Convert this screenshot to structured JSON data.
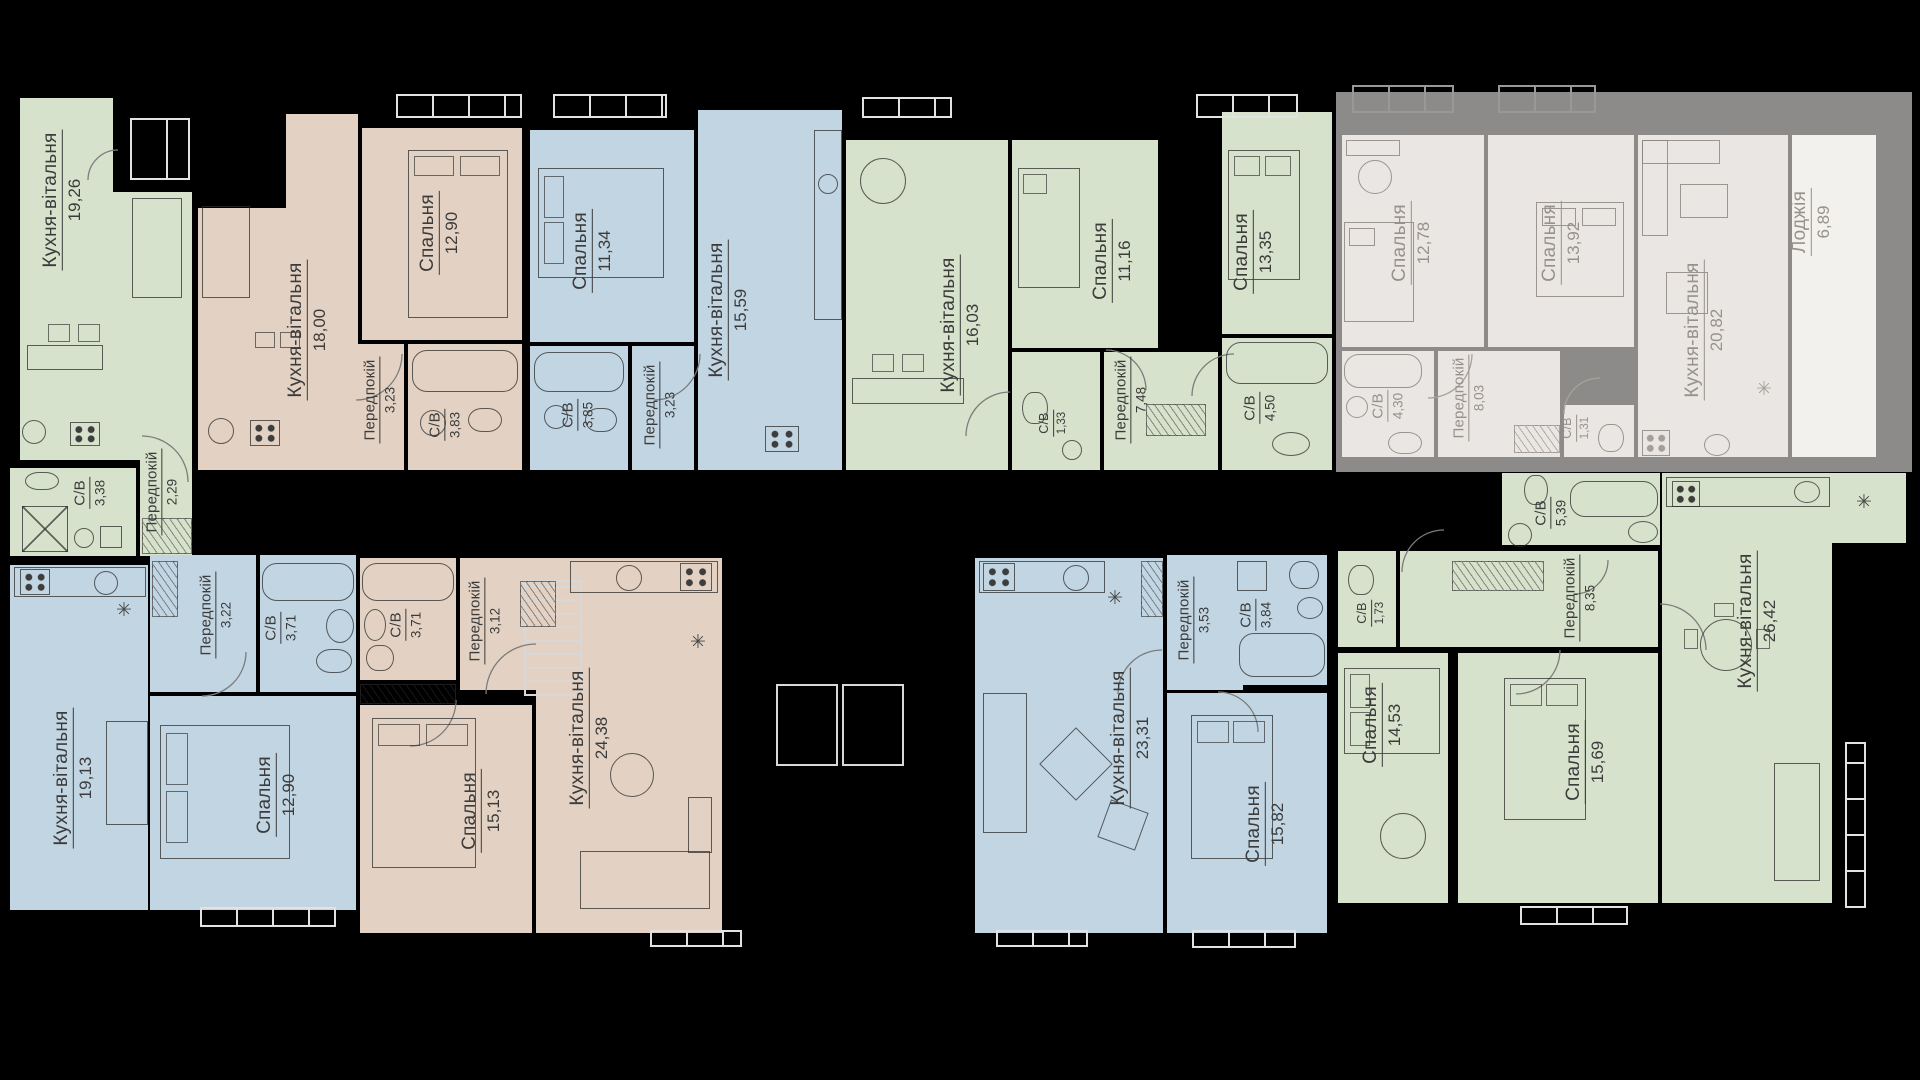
{
  "page": {
    "background": "#000000",
    "colors": {
      "green": "#d6e2cb",
      "tan": "#e3d2c3",
      "blue": "#c2d5e2",
      "faded_fill": "#e9e6e3",
      "faded_wall": "#8d8b89"
    }
  },
  "icons": {
    "fixture": "✳"
  },
  "apartments": [
    {
      "id": "top-1",
      "palette": "green",
      "status": "available",
      "rooms": [
        {
          "name": "Кухня-вітальня",
          "area": "19,26"
        },
        {
          "name": "С/В",
          "area": "3,38"
        },
        {
          "name": "Передпокій",
          "area": "2,29"
        }
      ]
    },
    {
      "id": "top-2",
      "palette": "tan",
      "status": "available",
      "rooms": [
        {
          "name": "Кухня-вітальня",
          "area": "18,00"
        },
        {
          "name": "Спальня",
          "area": "12,90"
        },
        {
          "name": "Передпокій",
          "area": "3,23"
        },
        {
          "name": "С/В",
          "area": "3,83"
        }
      ]
    },
    {
      "id": "top-3",
      "palette": "blue",
      "status": "available",
      "rooms": [
        {
          "name": "Спальня",
          "area": "11,34"
        },
        {
          "name": "С/В",
          "area": "3,85"
        },
        {
          "name": "Передпокій",
          "area": "3,23"
        },
        {
          "name": "Кухня-вітальня",
          "area": "15,59"
        }
      ]
    },
    {
      "id": "top-4",
      "palette": "green",
      "status": "available",
      "rooms": [
        {
          "name": "Кухня-вітальня",
          "area": "16,03"
        },
        {
          "name": "Спальня",
          "area": "11,16"
        },
        {
          "name": "С/В",
          "area": "1,33"
        },
        {
          "name": "Передпокій",
          "area": "7,48"
        },
        {
          "name": "Спальня",
          "area": "13,35"
        },
        {
          "name": "С/В",
          "area": "4,50"
        }
      ]
    },
    {
      "id": "top-5",
      "palette": "faded",
      "status": "unavailable",
      "rooms": [
        {
          "name": "Спальня",
          "area": "12,78"
        },
        {
          "name": "Спальня",
          "area": "13,92"
        },
        {
          "name": "Кухня-вітальня",
          "area": "20,82"
        },
        {
          "name": "Лоджія",
          "area": "6,89"
        },
        {
          "name": "С/В",
          "area": "4,30"
        },
        {
          "name": "Передпокій",
          "area": "8,03"
        },
        {
          "name": "С/В",
          "area": "1,31"
        }
      ]
    },
    {
      "id": "bottom-1",
      "palette": "blue",
      "status": "available",
      "rooms": [
        {
          "name": "Кухня-вітальня",
          "area": "19,13"
        },
        {
          "name": "Передпокій",
          "area": "3,22"
        },
        {
          "name": "С/В",
          "area": "3,71"
        },
        {
          "name": "Спальня",
          "area": "12,90"
        }
      ]
    },
    {
      "id": "bottom-2",
      "palette": "tan",
      "status": "available",
      "rooms": [
        {
          "name": "С/В",
          "area": "3,71"
        },
        {
          "name": "Передпокій",
          "area": "3,12"
        },
        {
          "name": "Спальня",
          "area": "15,13"
        },
        {
          "name": "Кухня-вітальня",
          "area": "24,38"
        }
      ]
    },
    {
      "id": "bottom-3",
      "palette": "blue",
      "status": "available",
      "rooms": [
        {
          "name": "Кухня-вітальня",
          "area": "23,31"
        },
        {
          "name": "Передпокій",
          "area": "3,53"
        },
        {
          "name": "С/В",
          "area": "3,84"
        },
        {
          "name": "Спальня",
          "area": "15,82"
        }
      ]
    },
    {
      "id": "bottom-4",
      "palette": "green",
      "status": "available",
      "rooms": [
        {
          "name": "С/В",
          "area": "5,39"
        },
        {
          "name": "Передпокій",
          "area": "8,35"
        },
        {
          "name": "С/В",
          "area": "1,73"
        },
        {
          "name": "Спальня",
          "area": "14,53"
        },
        {
          "name": "Спальня",
          "area": "15,69"
        },
        {
          "name": "Кухня-вітальня",
          "area": "26,42"
        }
      ]
    }
  ]
}
